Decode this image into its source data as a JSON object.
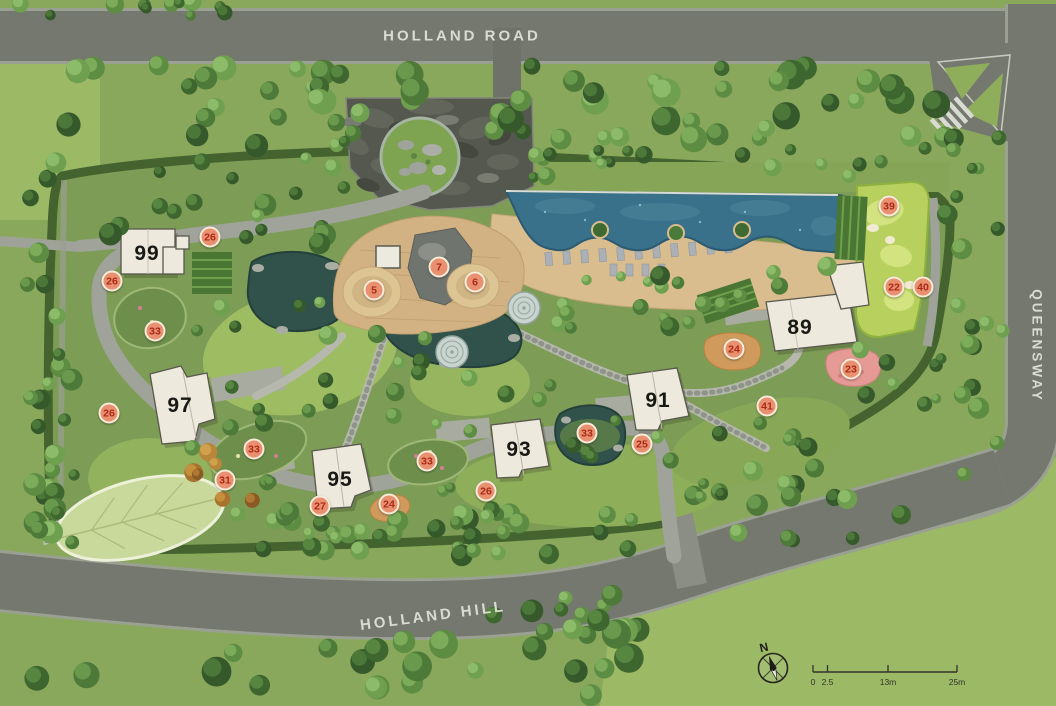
{
  "plan": {
    "roads": {
      "holland_road": "HOLLAND ROAD",
      "queensway": "QUEENSWAY",
      "holland_hill": "HOLLAND HILL"
    },
    "buildings": [
      {
        "label": "99",
        "x": 147,
        "y": 254
      },
      {
        "label": "97",
        "x": 180,
        "y": 406
      },
      {
        "label": "95",
        "x": 340,
        "y": 480
      },
      {
        "label": "93",
        "x": 519,
        "y": 450
      },
      {
        "label": "91",
        "x": 658,
        "y": 401
      },
      {
        "label": "89",
        "x": 800,
        "y": 328
      }
    ],
    "markers": [
      {
        "n": "26",
        "x": 210,
        "y": 237
      },
      {
        "n": "26",
        "x": 112,
        "y": 281
      },
      {
        "n": "33",
        "x": 155,
        "y": 331
      },
      {
        "n": "26",
        "x": 109,
        "y": 413
      },
      {
        "n": "33",
        "x": 254,
        "y": 449
      },
      {
        "n": "31",
        "x": 225,
        "y": 480
      },
      {
        "n": "27",
        "x": 320,
        "y": 506
      },
      {
        "n": "24",
        "x": 389,
        "y": 504
      },
      {
        "n": "33",
        "x": 427,
        "y": 461
      },
      {
        "n": "26",
        "x": 486,
        "y": 491
      },
      {
        "n": "5",
        "x": 374,
        "y": 290
      },
      {
        "n": "7",
        "x": 439,
        "y": 267
      },
      {
        "n": "6",
        "x": 475,
        "y": 282
      },
      {
        "n": "33",
        "x": 587,
        "y": 433
      },
      {
        "n": "25",
        "x": 642,
        "y": 444
      },
      {
        "n": "39",
        "x": 889,
        "y": 206
      },
      {
        "n": "22",
        "x": 894,
        "y": 287
      },
      {
        "n": "40",
        "x": 923,
        "y": 287
      },
      {
        "n": "24",
        "x": 734,
        "y": 349
      },
      {
        "n": "23",
        "x": 851,
        "y": 369
      },
      {
        "n": "41",
        "x": 767,
        "y": 406
      }
    ],
    "compass": {
      "north_label": "N"
    },
    "scale_bar": {
      "tick_labels": [
        "0",
        "2.5",
        "13m",
        "25m"
      ]
    }
  },
  "colors": {
    "marker_fill": "#e8906f",
    "marker_text": "#aa2a17",
    "marker_ring": "#f7ecd9",
    "road_surface": "#75786e",
    "road_text": "#dadcd2",
    "pool_water": "#39708a",
    "pond_water": "#31524a",
    "deck_sand": "#d9bd8e",
    "putting_green": "#b8d05e",
    "building_roof": "#edeadd"
  }
}
